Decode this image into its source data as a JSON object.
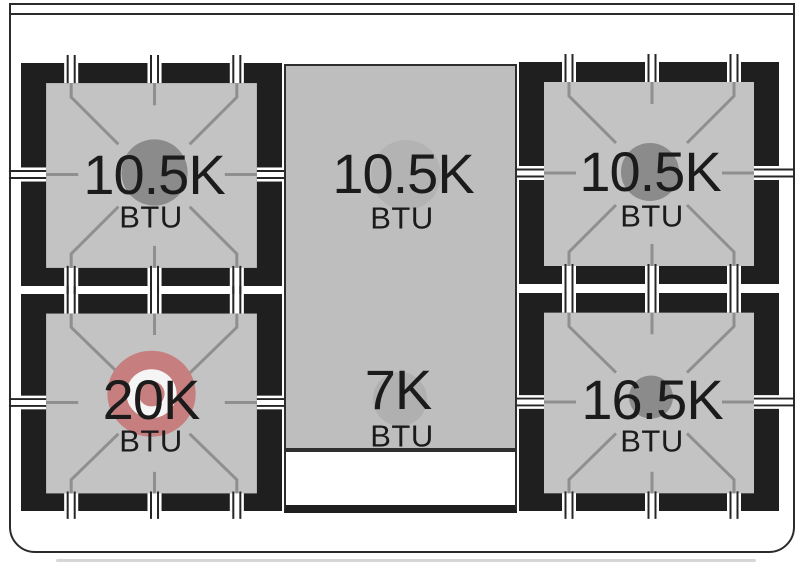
{
  "cooktop": {
    "description": "Gas range cooktop burner layout diagram",
    "burners": [
      {
        "position": "top-left",
        "value": "10.5K",
        "unit": "BTU",
        "cap_color": "#8b8b8b"
      },
      {
        "position": "top-center-griddle",
        "value": "10.5K",
        "unit": "BTU",
        "cap_color": "#b3b3b3"
      },
      {
        "position": "top-right",
        "value": "10.5K",
        "unit": "BTU",
        "cap_color": "#8b8b8b"
      },
      {
        "position": "bottom-left",
        "value": "20K",
        "unit": "BTU",
        "cap_color": "#c67e7e"
      },
      {
        "position": "bottom-center-griddle",
        "value": "7K",
        "unit": "BTU",
        "cap_color": "#b0b0b0"
      },
      {
        "position": "bottom-right",
        "value": "16.5K",
        "unit": "BTU",
        "cap_color": "#8b8b8b"
      }
    ],
    "colors": {
      "grate_black": "#1f1f1f",
      "grate_surface_gray": "#c3c3c3",
      "grate_line_gray": "#8f8f8f",
      "griddle_gray": "#bebebe",
      "power_burner_ring_red": "#c67e7e",
      "power_burner_ring_inner_white": "#f5f5f5",
      "outline_dark": "#2b2b2b",
      "text_dark": "#1b1b1b"
    }
  }
}
